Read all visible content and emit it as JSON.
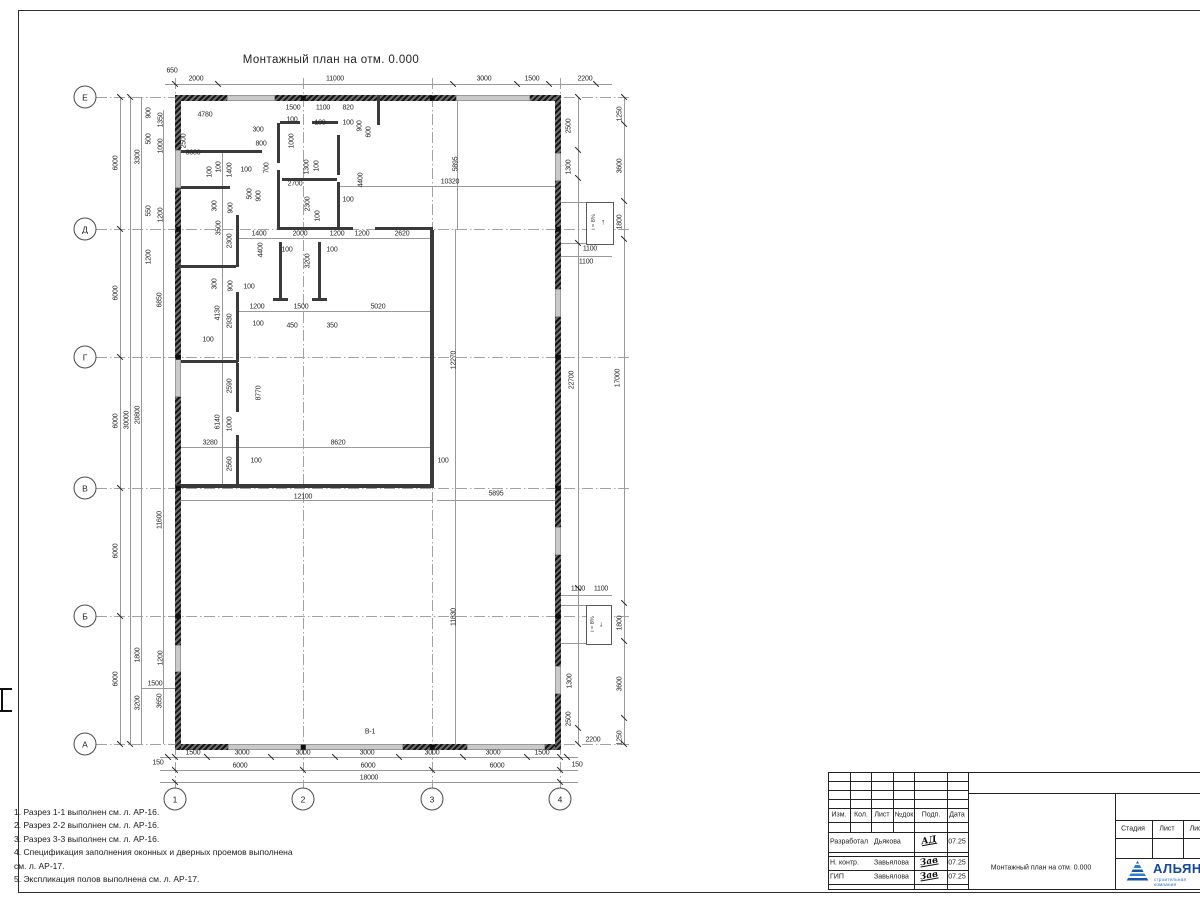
{
  "drawing": {
    "title": "Монтажный план на отм. 0.000",
    "window_mark": "В-1"
  },
  "axes": [
    [
      "Е",
      85,
      97
    ],
    [
      "Д",
      85,
      229
    ],
    [
      "Г",
      85,
      357
    ],
    [
      "В",
      85,
      488
    ],
    [
      "Б",
      85,
      616
    ],
    [
      "А",
      85,
      744
    ],
    [
      "1",
      175,
      799
    ],
    [
      "2",
      303,
      799
    ],
    [
      "3",
      432,
      799
    ],
    [
      "4",
      560,
      799
    ]
  ],
  "walls": [
    [
      175,
      95,
      386,
      6,
      "o"
    ],
    [
      175,
      744,
      386,
      6,
      "o"
    ],
    [
      175,
      95,
      6,
      655,
      "o"
    ],
    [
      555,
      95,
      6,
      655,
      "o"
    ],
    [
      175,
      150,
      87,
      3,
      "i"
    ],
    [
      277,
      123,
      3,
      40,
      "i"
    ],
    [
      277,
      170,
      3,
      60,
      "i"
    ],
    [
      280,
      121,
      20,
      3,
      "i"
    ],
    [
      312,
      121,
      26,
      3,
      "i"
    ],
    [
      377,
      95,
      3,
      30,
      "i"
    ],
    [
      337,
      135,
      3,
      40,
      "i"
    ],
    [
      337,
      182,
      3,
      47,
      "i"
    ],
    [
      282,
      178,
      55,
      3,
      "i"
    ],
    [
      280,
      227,
      73,
      3,
      "i"
    ],
    [
      375,
      227,
      58,
      3,
      "i"
    ],
    [
      430,
      230,
      4,
      258,
      "i"
    ],
    [
      175,
      186,
      55,
      3,
      "i"
    ],
    [
      236,
      215,
      3,
      52,
      "i"
    ],
    [
      236,
      292,
      3,
      70,
      "i"
    ],
    [
      236,
      363,
      3,
      49,
      "i"
    ],
    [
      236,
      435,
      3,
      53,
      "i"
    ],
    [
      175,
      265,
      61,
      3,
      "i"
    ],
    [
      175,
      360,
      63,
      3,
      "i"
    ],
    [
      175,
      484,
      259,
      4,
      "i"
    ],
    [
      279,
      242,
      3,
      58,
      "i"
    ],
    [
      273,
      298,
      15,
      3,
      "i"
    ],
    [
      318,
      242,
      3,
      58,
      "i"
    ],
    [
      312,
      298,
      15,
      3,
      "i"
    ]
  ],
  "windows": [
    [
      227,
      95,
      48,
      6
    ],
    [
      456,
      95,
      74,
      6
    ],
    [
      228,
      744,
      175,
      6
    ],
    [
      467,
      744,
      78,
      6
    ],
    [
      175,
      150,
      6,
      38
    ],
    [
      175,
      358,
      6,
      39
    ],
    [
      175,
      645,
      6,
      27
    ],
    [
      555,
      153,
      6,
      28
    ],
    [
      555,
      289,
      6,
      28
    ],
    [
      555,
      527,
      6,
      28
    ],
    [
      555,
      666,
      6,
      28
    ]
  ],
  "squares": [
    [
      178,
      229
    ],
    [
      178,
      357
    ],
    [
      178,
      488
    ],
    [
      178,
      616
    ],
    [
      558,
      229
    ],
    [
      558,
      357
    ],
    [
      558,
      488
    ],
    [
      558,
      616
    ],
    [
      303,
      98
    ],
    [
      432,
      98
    ],
    [
      303,
      747
    ],
    [
      432,
      747
    ]
  ],
  "dimlines_h": [
    [
      165,
      84,
      447
    ],
    [
      160,
      757,
      418
    ],
    [
      160,
      770,
      418
    ],
    [
      160,
      782,
      418
    ],
    [
      340,
      186,
      216
    ],
    [
      237,
      238,
      195
    ],
    [
      237,
      311,
      195
    ],
    [
      176,
      447,
      256
    ],
    [
      176,
      500,
      256
    ],
    [
      437,
      500,
      119
    ],
    [
      561,
      202,
      25
    ],
    [
      561,
      243,
      25
    ],
    [
      561,
      256,
      51
    ],
    [
      561,
      595,
      51
    ],
    [
      561,
      605,
      25
    ],
    [
      561,
      643,
      25
    ],
    [
      141,
      688,
      34
    ]
  ],
  "dimlines_v": [
    [
      120,
      97,
      647
    ],
    [
      130,
      97,
      647
    ],
    [
      141,
      97,
      647
    ],
    [
      163,
      110,
      634
    ],
    [
      578,
      97,
      647
    ],
    [
      624,
      97,
      647
    ],
    [
      457,
      101,
      128
    ],
    [
      455,
      229,
      515
    ],
    [
      222,
      152,
      336
    ]
  ],
  "axislines_h": [
    [
      96,
      97,
      534
    ],
    [
      96,
      229,
      534
    ],
    [
      96,
      357,
      534
    ],
    [
      96,
      488,
      534
    ],
    [
      96,
      616,
      534
    ],
    [
      96,
      744,
      534
    ]
  ],
  "axislines_v": [
    [
      175,
      78,
      710
    ],
    [
      303,
      78,
      710
    ],
    [
      432,
      78,
      710
    ],
    [
      560,
      78,
      710
    ]
  ],
  "ticks": [
    [
      175,
      84
    ],
    [
      218,
      84
    ],
    [
      453,
      84
    ],
    [
      517,
      84
    ],
    [
      549,
      84
    ],
    [
      596,
      84
    ],
    [
      168,
      757
    ],
    [
      175,
      757
    ],
    [
      207,
      757
    ],
    [
      271,
      757
    ],
    [
      335,
      757
    ],
    [
      399,
      757
    ],
    [
      463,
      757
    ],
    [
      527,
      757
    ],
    [
      560,
      757
    ],
    [
      567,
      757
    ],
    [
      175,
      770
    ],
    [
      303,
      770
    ],
    [
      432,
      770
    ],
    [
      560,
      770
    ],
    [
      175,
      782
    ],
    [
      560,
      782
    ],
    [
      120,
      97
    ],
    [
      120,
      229
    ],
    [
      120,
      357
    ],
    [
      120,
      488
    ],
    [
      120,
      616
    ],
    [
      120,
      744
    ],
    [
      130,
      97
    ],
    [
      130,
      744
    ],
    [
      578,
      97
    ],
    [
      578,
      150
    ],
    [
      578,
      178
    ],
    [
      578,
      243
    ],
    [
      578,
      588
    ],
    [
      578,
      728
    ],
    [
      578,
      744
    ],
    [
      624,
      97
    ],
    [
      624,
      124
    ],
    [
      624,
      201
    ],
    [
      624,
      239
    ],
    [
      624,
      603
    ],
    [
      624,
      641
    ],
    [
      624,
      718
    ],
    [
      624,
      744
    ]
  ],
  "dims": [
    [
      "650",
      172,
      71,
      0
    ],
    [
      "2000",
      196,
      79,
      0
    ],
    [
      "11000",
      335,
      79,
      0
    ],
    [
      "3000",
      484,
      79,
      0
    ],
    [
      "1500",
      532,
      79,
      0
    ],
    [
      "2200",
      585,
      79,
      0
    ],
    [
      "1500",
      293,
      108,
      0
    ],
    [
      "1100",
      323,
      108,
      0
    ],
    [
      "820",
      348,
      108,
      0
    ],
    [
      "100",
      292,
      120,
      0
    ],
    [
      "100",
      320,
      123,
      0
    ],
    [
      "100",
      348,
      123,
      0
    ],
    [
      "900",
      360,
      126,
      1
    ],
    [
      "600",
      369,
      132,
      1
    ],
    [
      "6000",
      116,
      163,
      1
    ],
    [
      "6000",
      116,
      293,
      1
    ],
    [
      "6000",
      116,
      421,
      1
    ],
    [
      "6000",
      116,
      551,
      1
    ],
    [
      "6000",
      116,
      679,
      1
    ],
    [
      "30000",
      127,
      420,
      1
    ],
    [
      "900",
      149,
      113,
      1
    ],
    [
      "1350",
      161,
      120,
      1
    ],
    [
      "3300",
      138,
      157,
      1
    ],
    [
      "500",
      149,
      139,
      1
    ],
    [
      "1000",
      161,
      146,
      1
    ],
    [
      "550",
      149,
      211,
      1
    ],
    [
      "1200",
      161,
      215,
      1
    ],
    [
      "1200",
      149,
      257,
      1
    ],
    [
      "6850",
      160,
      300,
      1
    ],
    [
      "20800",
      138,
      415,
      1
    ],
    [
      "11600",
      160,
      520,
      1
    ],
    [
      "1800",
      138,
      655,
      1
    ],
    [
      "1200",
      161,
      658,
      1
    ],
    [
      "1500",
      155,
      684,
      0
    ],
    [
      "3200",
      138,
      703,
      1
    ],
    [
      "3650",
      160,
      701,
      1
    ],
    [
      "2500",
      569,
      126,
      1
    ],
    [
      "1300",
      569,
      167,
      1
    ],
    [
      "1250",
      620,
      114,
      1
    ],
    [
      "3600",
      620,
      166,
      1
    ],
    [
      "1800",
      620,
      222,
      1
    ],
    [
      "1100",
      590,
      249,
      0
    ],
    [
      "1100",
      586,
      262,
      0
    ],
    [
      "22700",
      572,
      380,
      1
    ],
    [
      "17000",
      618,
      378,
      1
    ],
    [
      "1100",
      578,
      589,
      0
    ],
    [
      "1100",
      601,
      589,
      0
    ],
    [
      "1800",
      620,
      623,
      1
    ],
    [
      "3600",
      620,
      684,
      1
    ],
    [
      "1300",
      570,
      681,
      1
    ],
    [
      "2500",
      569,
      719,
      1
    ],
    [
      "2200",
      593,
      740,
      0
    ],
    [
      "1250",
      620,
      738,
      1
    ],
    [
      "150",
      577,
      765,
      0
    ],
    [
      "150",
      158,
      763,
      0
    ],
    [
      "1500",
      193,
      753,
      0
    ],
    [
      "3000",
      242,
      753,
      0
    ],
    [
      "3000",
      303,
      753,
      0
    ],
    [
      "3000",
      367,
      753,
      0
    ],
    [
      "3000",
      432,
      753,
      0
    ],
    [
      "3000",
      493,
      753,
      0
    ],
    [
      "1500",
      542,
      753,
      0
    ],
    [
      "6000",
      240,
      766,
      0
    ],
    [
      "6000",
      368,
      766,
      0
    ],
    [
      "6000",
      497,
      766,
      0
    ],
    [
      "18000",
      369,
      778,
      0
    ],
    [
      "4780",
      205,
      115,
      0
    ],
    [
      "2500",
      184,
      141,
      1
    ],
    [
      "3680",
      193,
      153,
      0
    ],
    [
      "300",
      258,
      130,
      0
    ],
    [
      "800",
      261,
      144,
      0
    ],
    [
      "1000",
      292,
      141,
      1
    ],
    [
      "1300",
      307,
      167,
      1
    ],
    [
      "100",
      317,
      166,
      1
    ],
    [
      "4400",
      361,
      180,
      1
    ],
    [
      "2700",
      295,
      184,
      0
    ],
    [
      "100",
      348,
      200,
      0
    ],
    [
      "2300",
      308,
      204,
      1
    ],
    [
      "100",
      318,
      216,
      1
    ],
    [
      "5895",
      456,
      164,
      1
    ],
    [
      "10320",
      450,
      182,
      0
    ],
    [
      "1400",
      230,
      170,
      1
    ],
    [
      "100",
      219,
      167,
      1
    ],
    [
      "100",
      210,
      172,
      1
    ],
    [
      "700",
      267,
      168,
      1
    ],
    [
      "100",
      246,
      170,
      0
    ],
    [
      "500",
      250,
      194,
      1
    ],
    [
      "900",
      259,
      196,
      1
    ],
    [
      "300",
      215,
      206,
      1
    ],
    [
      "900",
      231,
      208,
      1
    ],
    [
      "3500",
      219,
      228,
      1
    ],
    [
      "2300",
      230,
      241,
      1
    ],
    [
      "1400",
      259,
      234,
      0
    ],
    [
      "2000",
      300,
      234,
      0
    ],
    [
      "1200",
      337,
      234,
      0
    ],
    [
      "1200",
      362,
      234,
      0
    ],
    [
      "2620",
      402,
      234,
      0
    ],
    [
      "100",
      287,
      250,
      0
    ],
    [
      "100",
      332,
      250,
      0
    ],
    [
      "4400",
      261,
      250,
      1
    ],
    [
      "3200",
      308,
      261,
      1
    ],
    [
      "300",
      215,
      284,
      1
    ],
    [
      "900",
      231,
      286,
      1
    ],
    [
      "100",
      249,
      287,
      0
    ],
    [
      "1200",
      257,
      307,
      0
    ],
    [
      "1500",
      301,
      307,
      0
    ],
    [
      "5020",
      378,
      307,
      0
    ],
    [
      "100",
      258,
      324,
      0
    ],
    [
      "450",
      292,
      326,
      0
    ],
    [
      "350",
      332,
      326,
      0
    ],
    [
      "4130",
      218,
      313,
      1
    ],
    [
      "2930",
      230,
      321,
      1
    ],
    [
      "100",
      208,
      340,
      0
    ],
    [
      "2590",
      230,
      386,
      1
    ],
    [
      "8770",
      259,
      393,
      1
    ],
    [
      "12270",
      454,
      360,
      1
    ],
    [
      "6140",
      218,
      422,
      1
    ],
    [
      "1000",
      230,
      424,
      1
    ],
    [
      "3280",
      210,
      443,
      0
    ],
    [
      "8620",
      338,
      443,
      0
    ],
    [
      "2560",
      230,
      464,
      1
    ],
    [
      "100",
      256,
      461,
      0
    ],
    [
      "100",
      443,
      461,
      0
    ],
    [
      "12100",
      303,
      497,
      0
    ],
    [
      "5895",
      496,
      494,
      0
    ],
    [
      "11830",
      454,
      617,
      1
    ]
  ],
  "ramps": [
    {
      "x": 586,
      "y": 202,
      "w": 26,
      "h": 41,
      "label": "i = 8%",
      "arrow": "↑",
      "tx": 594,
      "ty": 222,
      "ax": 603,
      "ay": 222
    },
    {
      "x": 586,
      "y": 605,
      "w": 24,
      "h": 38,
      "label": "i = 8%",
      "arrow": "↓",
      "tx": 593,
      "ty": 624,
      "ax": 601,
      "ay": 624
    }
  ],
  "notes": [
    "1. Разрез 1-1 выполнен см. л. АР-16.",
    "2. Разрез 2-2 выполнен см. л. АР-16.",
    "3. Разрез 3-3 выполнен см. л. АР-16.",
    "4. Спецификация заполнения оконных и дверных проемов выполнена",
    "см. л. АР-17.",
    "5. Экспликация полов выполнена см. л. АР-17."
  ],
  "stamp": {
    "cols": {
      "c1": "Изм.",
      "c2": "Кол.",
      "c3": "Лист",
      "c4": "№док",
      "c5": "Подп.",
      "c6": "Дата"
    },
    "rows": {
      "r1_role": "Разработал",
      "r1_name": "Дьякова",
      "r1_sig": "АД",
      "r1_date": "07.25",
      "r2_role": "Н. контр.",
      "r2_name": "Завьялова",
      "r2_sig": "Зав",
      "r2_date": "07.25",
      "r3_role": "ГИП",
      "r3_name": "Завьялова",
      "r3_sig": "Зав",
      "r3_date": "07.25"
    },
    "doc_title": "Монтажный план на отм. 0.000",
    "right_cols": {
      "c1": "Стадия",
      "c2": "Лист",
      "c3": "Листов"
    },
    "logo": {
      "name": "АЛЬЯНС",
      "tagline": "строительная компания"
    }
  }
}
